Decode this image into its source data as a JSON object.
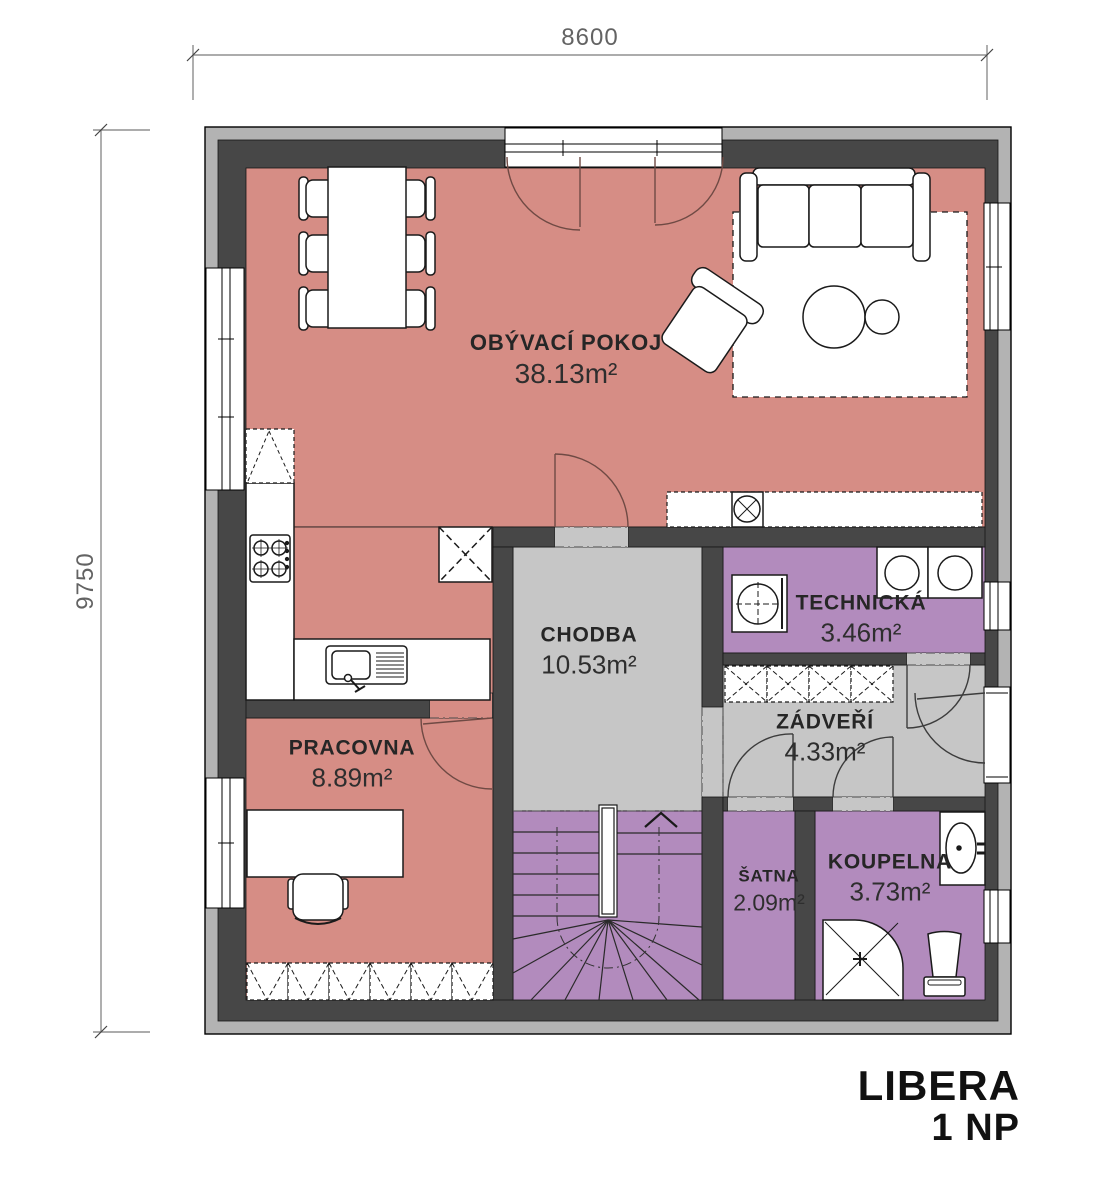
{
  "title": {
    "project": "LIBERA",
    "floor": "1 NP"
  },
  "dimensions": {
    "width": "8600",
    "height": "9750"
  },
  "rooms": [
    {
      "name": "OBÝVACÍ POKOJ",
      "area": "38.13m²",
      "color": "#d68d85"
    },
    {
      "name": "CHODBA",
      "area": "10.53m²",
      "color": "#c6c6c6"
    },
    {
      "name": "TECHNICKÁ",
      "area": "3.46m²",
      "color": "#b28bbd"
    },
    {
      "name": "ZÁDVEŘÍ",
      "area": "4.33m²",
      "color": "#c6c6c6"
    },
    {
      "name": "PRACOVNA",
      "area": "8.89m²",
      "color": "#d68d85"
    },
    {
      "name": "ŠATNA",
      "area": "2.09m²",
      "color": "#b28bbd"
    },
    {
      "name": "KOUPELNA",
      "area": "3.73m²",
      "color": "#b28bbd"
    }
  ],
  "palette": {
    "wall_dark": "#474747",
    "wall_light": "#b3b3b3",
    "floor_pink": "#d68d85",
    "floor_gray": "#c6c6c6",
    "floor_purple": "#b28bbd",
    "door_arc_red": "#6f4a44",
    "door_arc_dark": "#3c3c3c",
    "dimension_line": "#7a7a7a"
  },
  "furniture_icons": [
    "dining-table",
    "dining-chair",
    "sofa",
    "rug",
    "coffee-table",
    "armchair",
    "tall-cabinet",
    "kitchen-counter",
    "stove",
    "kitchen-sink",
    "fridge",
    "wall-counter",
    "counter-sink",
    "washing-machine",
    "appliance",
    "entry-wardrobe",
    "desk",
    "office-chair",
    "office-wardrobe",
    "stairs",
    "stairs-up-arrow",
    "bathroom-sink",
    "shower",
    "toilet",
    "entrance-door"
  ]
}
